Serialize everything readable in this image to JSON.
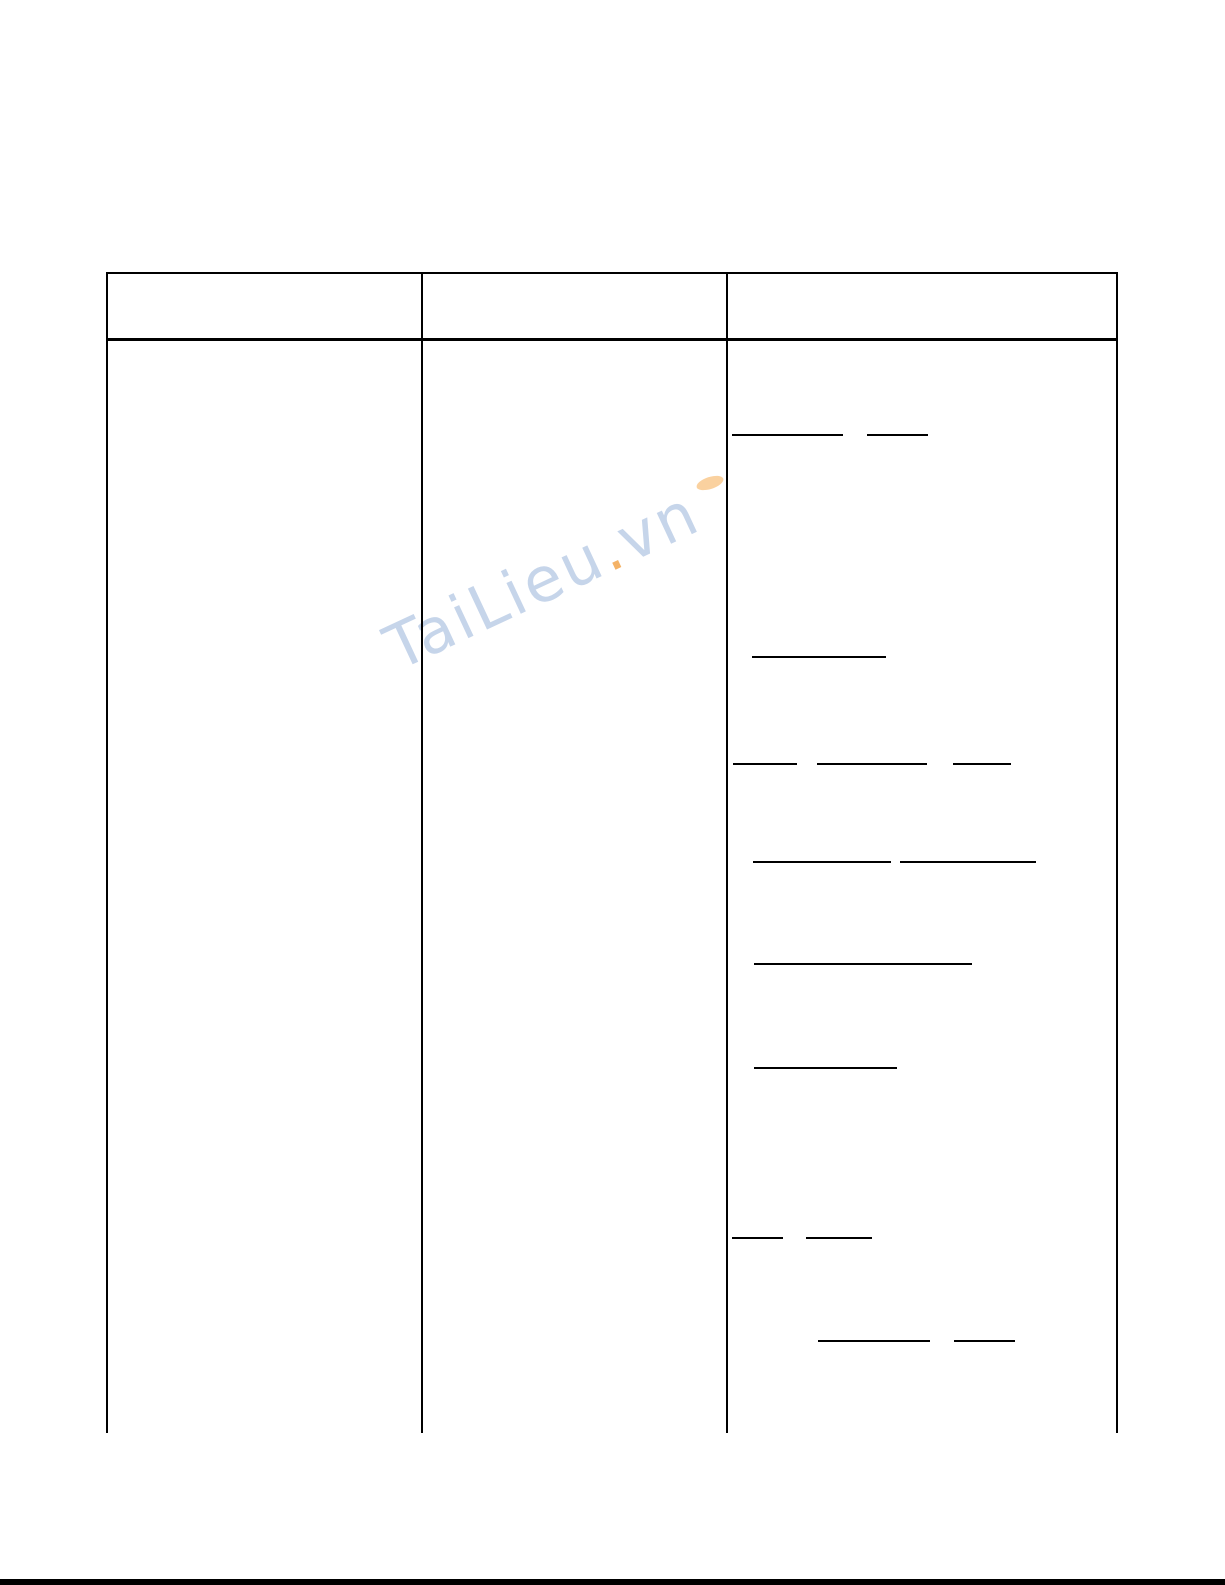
{
  "page": {
    "width": 1225,
    "height": 1585,
    "background": "#ffffff",
    "bottom_bar_color": "#000000"
  },
  "watermark": {
    "text_main": "TaiLieu",
    "text_dot": ".",
    "text_suffix": "vn",
    "color_main": "#c6d5ea",
    "color_dot": "#f4b266",
    "rotation_deg": -25
  },
  "table": {
    "x": 106,
    "y": 272,
    "right_x": 1118,
    "header_bottom_y": 338,
    "body_end_y": 1433,
    "col_separators_x": [
      421,
      726
    ],
    "border_color": "#000000",
    "columns": [
      {
        "label": ""
      },
      {
        "label": ""
      },
      {
        "label": ""
      }
    ],
    "blank_lines": [
      {
        "y": 434,
        "segments": [
          {
            "x": 732,
            "w": 111
          },
          {
            "x": 867,
            "w": 61
          }
        ]
      },
      {
        "y": 656,
        "segments": [
          {
            "x": 752,
            "w": 134
          }
        ]
      },
      {
        "y": 763,
        "segments": [
          {
            "x": 733,
            "w": 64
          },
          {
            "x": 817,
            "w": 110
          },
          {
            "x": 953,
            "w": 58
          }
        ]
      },
      {
        "y": 861,
        "segments": [
          {
            "x": 753,
            "w": 138
          },
          {
            "x": 900,
            "w": 136
          }
        ]
      },
      {
        "y": 963,
        "segments": [
          {
            "x": 754,
            "w": 218
          }
        ]
      },
      {
        "y": 1067,
        "segments": [
          {
            "x": 754,
            "w": 143
          }
        ]
      },
      {
        "y": 1237,
        "segments": [
          {
            "x": 732,
            "w": 51
          },
          {
            "x": 806,
            "w": 66
          }
        ]
      },
      {
        "y": 1340,
        "segments": [
          {
            "x": 818,
            "w": 112
          },
          {
            "x": 954,
            "w": 61
          }
        ]
      }
    ]
  }
}
